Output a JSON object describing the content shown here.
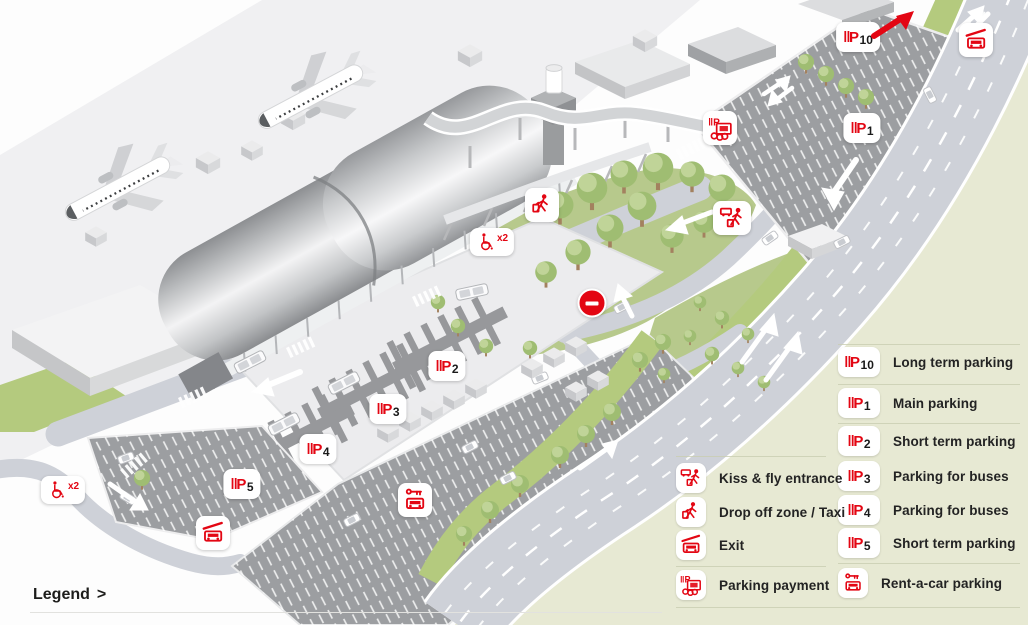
{
  "colors": {
    "red": "#e30613",
    "legend_bg": "#e7e9d3",
    "road": "#ced1d8",
    "lot": "#9c9ea1",
    "park": "#b7c98c",
    "lime": "#b4ca7e",
    "text": "#232323"
  },
  "map": {
    "p_glyph": "‖P",
    "wheelchair_label": "x2",
    "p_numbers": {
      "p10": "10",
      "p1": "1",
      "p2": "2",
      "p3": "3",
      "p4": "4",
      "p5": "5"
    }
  },
  "legend": {
    "link_label": "Legend",
    "link_chevron": ">",
    "left_items": [
      {
        "icon": "kissfly-icon",
        "label": "Kiss & fly entrance"
      },
      {
        "icon": "dropoff-icon",
        "label": "Drop off zone / Taxi"
      },
      {
        "icon": "exit-icon",
        "label": "Exit"
      },
      {
        "icon": "payment-icon",
        "label": "Parking payment"
      }
    ],
    "right_items": [
      {
        "icon": "parking-icon",
        "number": "10",
        "label": "Long term parking"
      },
      {
        "icon": "parking-icon",
        "number": "1",
        "label": "Main parking"
      },
      {
        "icon": "parking-icon",
        "number": "2",
        "label": "Short term parking"
      },
      {
        "icon": "parking-icon",
        "number": "3",
        "label": "Parking for buses"
      },
      {
        "icon": "parking-icon",
        "number": "4",
        "label": "Parking for buses"
      },
      {
        "icon": "parking-icon",
        "number": "5",
        "label": "Short term parking"
      },
      {
        "icon": "rentacar-icon",
        "number": "",
        "label": "Rent-a-car parking"
      }
    ]
  }
}
